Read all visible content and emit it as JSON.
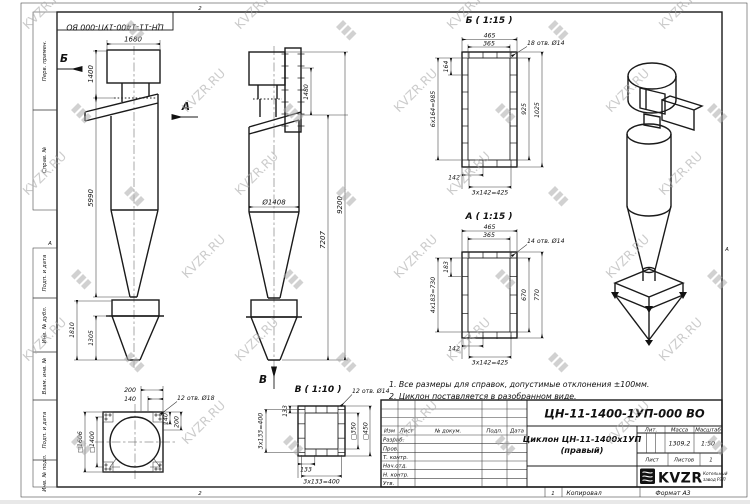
{
  "sheet": {
    "stamp_top": "ЦН-11-1400-1УП-000 ВО",
    "zone_top": "2",
    "zone_bottom_left": "2",
    "zone_bottom_right": "1",
    "fold_mark": "А",
    "footer": {
      "copied": "Копировал",
      "format": "Формат А3"
    }
  },
  "watermark": {
    "text": "KVZR.RU"
  },
  "sidebar": {
    "items": [
      "Перв. примен.",
      "Справ. №",
      "Подп. и дата",
      "Инв. № дубл.",
      "Взам. инв. №",
      "Подп. и дата",
      "Инв. № подл."
    ]
  },
  "notes": {
    "line1": "1. Все размеры для справок, допустимые отклонения ±100мм.",
    "line2": "2. Циклон поставляется в разобранном виде."
  },
  "front_view": {
    "label_b": "Б",
    "label_a": "А",
    "width": "1680",
    "inlet_height": "1400",
    "body_height": "5990",
    "bunker_height": "1810",
    "cone_height": "1305"
  },
  "side_view": {
    "label_v": "В",
    "pipe_height": "1480",
    "body_height": "7207",
    "total_height": "9200",
    "diameter": "Ø1408"
  },
  "section_b": {
    "title": "Б ( 1:15 )",
    "holes": "18 отв. Ø14",
    "width_outer": "465",
    "width_inner": "365",
    "pitch": "164",
    "pitch_total": "6х164=985",
    "height_inner": "925",
    "height_outer": "1025",
    "edge": "142",
    "pitch_bottom": "3х142=425"
  },
  "section_a": {
    "title": "А ( 1:15 )",
    "holes": "14 отв. Ø14",
    "width_outer": "465",
    "width_inner": "365",
    "pitch": "183",
    "pitch_total": "4х183=730",
    "height_inner": "670",
    "height_outer": "770",
    "edge": "142",
    "pitch_bottom": "3х142=425"
  },
  "section_v": {
    "title": "В ( 1:10 )",
    "holes": "12 отв. Ø14",
    "square_inner": "□350",
    "square_outer": "□450",
    "edge_left": "133",
    "pitch_left": "3х133=400",
    "edge_bottom": "133",
    "pitch_bottom": "3х133=400"
  },
  "plan_view": {
    "holes": "12 отв. Ø18",
    "offset_200": "200",
    "offset_140": "140",
    "square_outer": "□1606",
    "square_inner": "□1400",
    "offset_140_r": "140",
    "offset_200_r": "200"
  },
  "title_block": {
    "doc_number": "ЦН-11-1400-1УП-000 ВО",
    "name_line1": "Циклон ЦН-11-1400х1УП",
    "name_line2": "(правый)",
    "header": {
      "izm": "Изм",
      "list": "Лист",
      "doc": "№ докум.",
      "podp": "Подп.",
      "data": "Дата"
    },
    "rows": [
      "Разраб.",
      "Пров.",
      "Т. контр.",
      "Нач.отд.",
      "Н. контр.",
      "Утв."
    ],
    "lit_label": "Лит.",
    "mass_label": "Масса",
    "scale_label": "Масштаб",
    "mass": "1309,2",
    "scale": "1:50",
    "sheet_label": "Лист",
    "sheets_label": "Листов",
    "sheets_count": "1",
    "logo": "KVZR",
    "company_line1": "Котельный",
    "company_line2": "завод РЭП"
  }
}
